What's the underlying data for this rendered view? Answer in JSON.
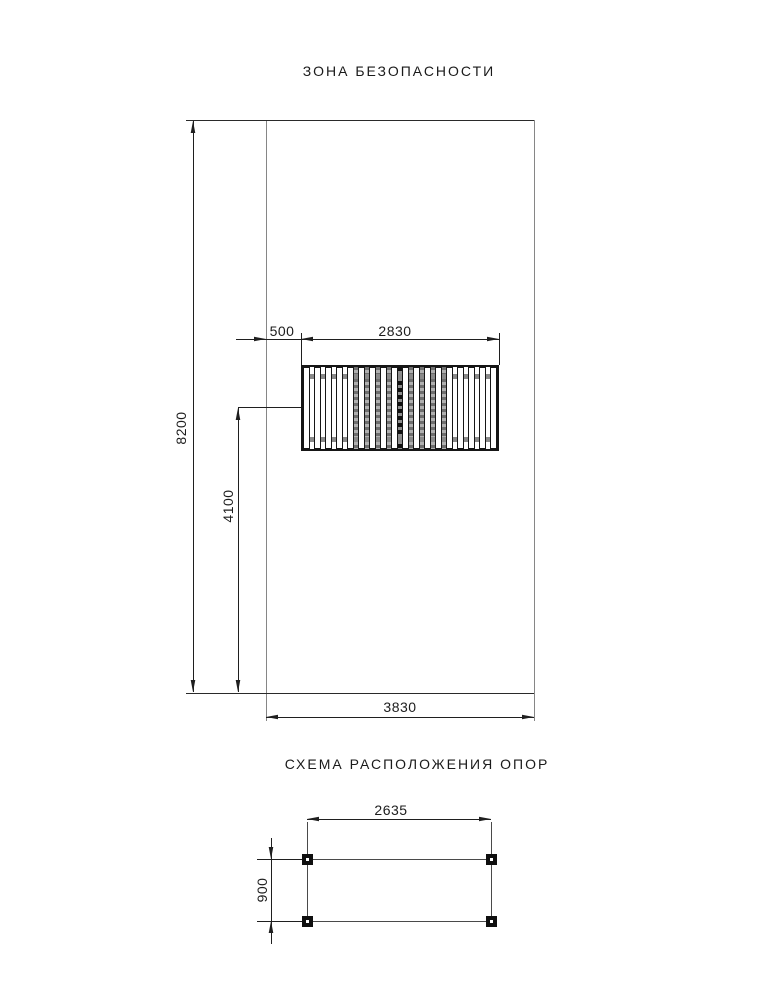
{
  "drawing": {
    "safety_zone": {
      "title": "ЗОНА БЕЗОПАСНОСТИ",
      "dim_height": "8200",
      "dim_width": "3830",
      "dim_bench_offset": "500",
      "dim_bench_width": "2830",
      "dim_bench_axis": "4100",
      "bench": {
        "slat_count": 18,
        "shaded_gap_start": 4,
        "shaded_gap_end": 12,
        "center_gap_index": 8
      }
    },
    "supports": {
      "title": "СХЕМА РАСПОЛОЖЕНИЯ ОПОР",
      "dim_span": "2635",
      "dim_depth": "900",
      "post_count": 4
    },
    "colors": {
      "line": "#1f1f1f",
      "gray_line": "#868686",
      "shade": "#9a9a9a",
      "background": "#ffffff"
    }
  }
}
